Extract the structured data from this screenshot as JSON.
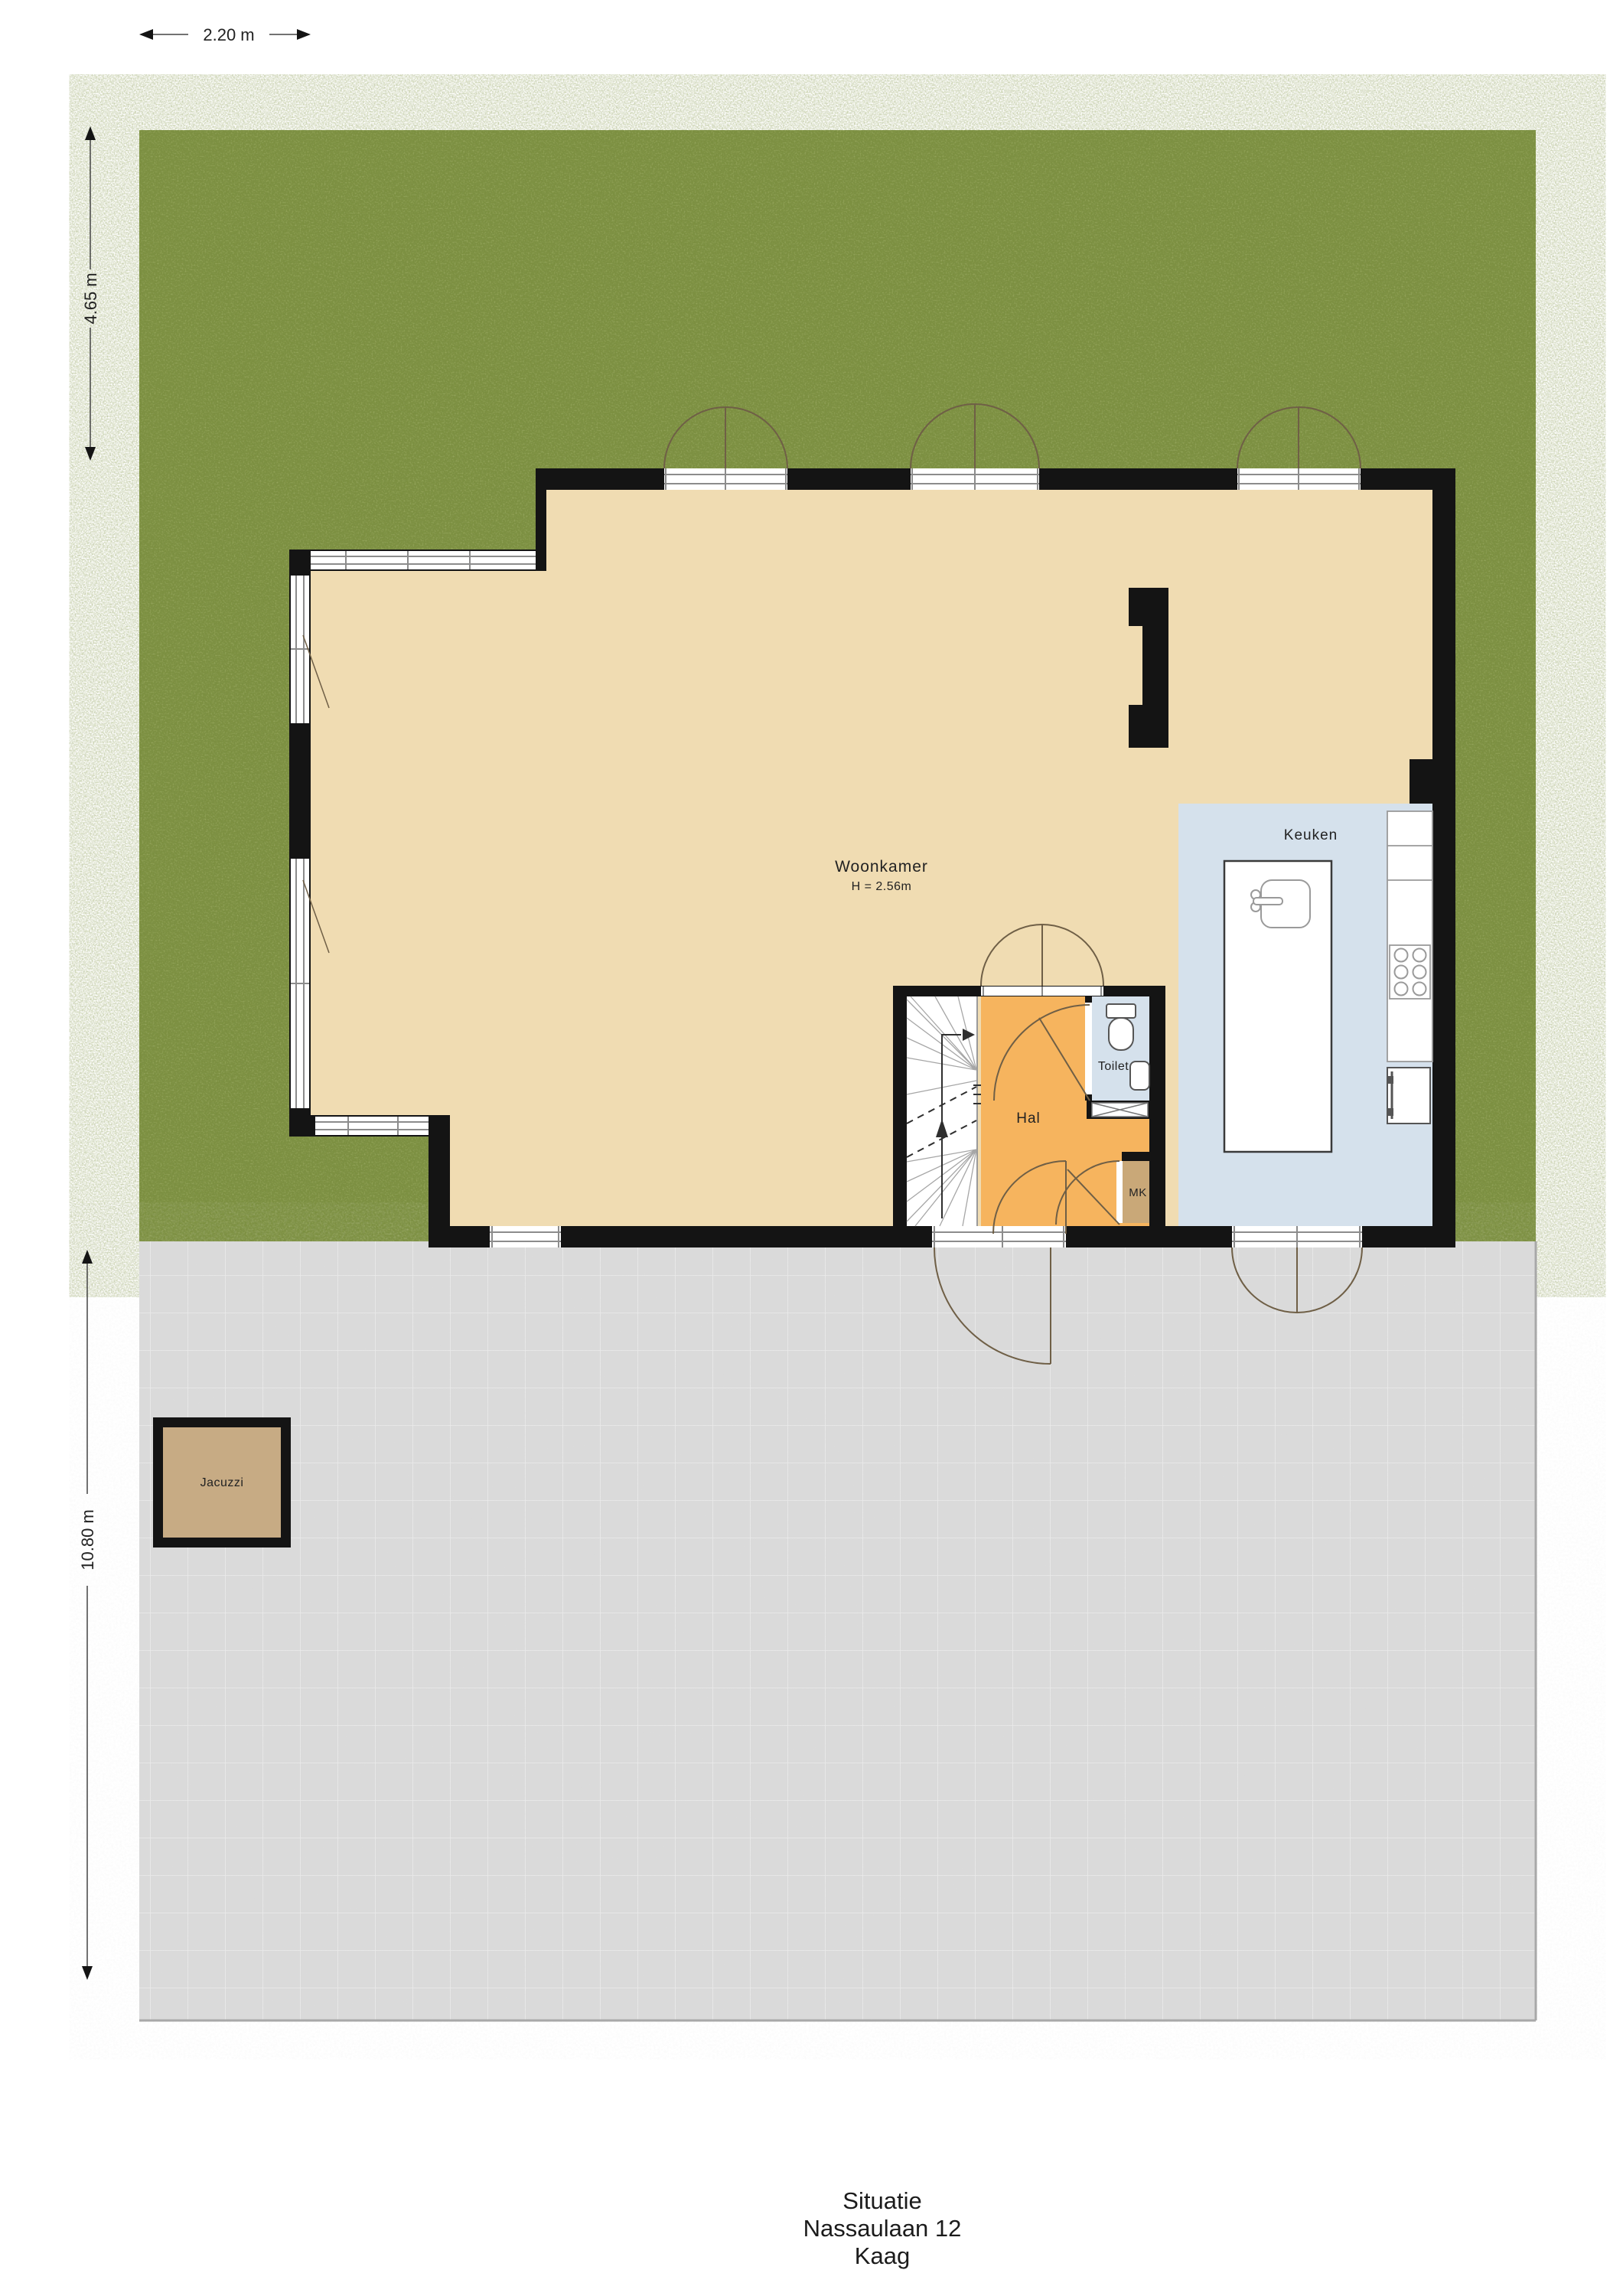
{
  "site": {
    "type": "floorplan-situation",
    "dimensions": {
      "top_width": "2.20 m",
      "left_upper_height": "4.65 m",
      "left_lower_height": "10.80 m"
    },
    "rooms": {
      "woonkamer": {
        "label": "Woonkamer",
        "height_note": "H = 2.56m"
      },
      "keuken": {
        "label": "Keuken"
      },
      "hal": {
        "label": "Hal"
      },
      "toilet": {
        "label": "Toilet"
      },
      "mk": {
        "label": "MK"
      },
      "jacuzzi": {
        "label": "Jacuzzi"
      }
    },
    "title_block": {
      "line1": "Situatie",
      "line2": "Nassaulaan 12",
      "line3": "Kaag"
    },
    "colors": {
      "grass": "#7b8f3f",
      "pavement": "#dadada",
      "pavement_line": "#ececec",
      "wall": "#141414",
      "woonkamer_floor": "#f0dcb2",
      "hal_floor": "#f6b45e",
      "kitchen_floor": "#d5e1ec",
      "toilet_floor": "#d5e1ec",
      "mk_floor": "#c9a878",
      "jacuzzi_fill": "#c7ab84",
      "stairs_floor": "#ffffff",
      "door_arc": "#6f5f46",
      "frame_gray": "#8c8c8c",
      "text": "#222222"
    }
  }
}
